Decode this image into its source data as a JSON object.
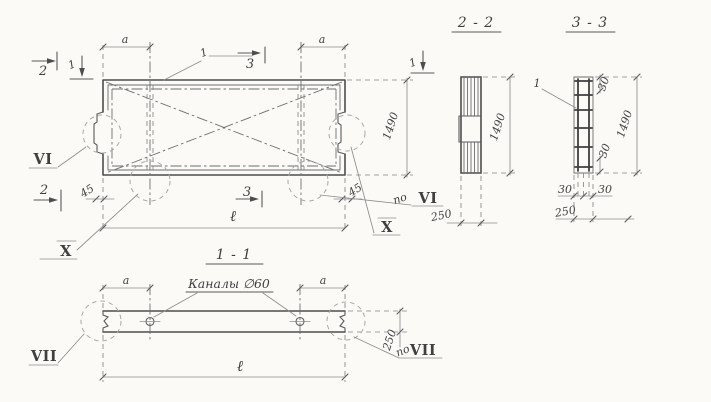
{
  "drawing": {
    "plan": {
      "dim_a": "a",
      "callout_1": "1",
      "mark_2": "2",
      "mark_1": "1",
      "mark_3": "3",
      "dim_45": "45",
      "dim_1490": "1490",
      "dim_l": "ℓ",
      "detail_vi": "VI",
      "po": "по",
      "detail_x": "X"
    },
    "section_2_2": {
      "title": "2 - 2",
      "dim_1490": "1490",
      "dim_250": "250"
    },
    "section_3_3": {
      "title": "3 - 3",
      "callout_1": "1",
      "dim_30": "30",
      "dim_1490": "1490",
      "dim_250": "250"
    },
    "section_1_1": {
      "title": "1 - 1",
      "dim_a": "a",
      "channels_label": "Каналы ∅60",
      "dim_l": "ℓ",
      "dim_250": "250",
      "po": "по",
      "detail_vii": "VII"
    }
  }
}
